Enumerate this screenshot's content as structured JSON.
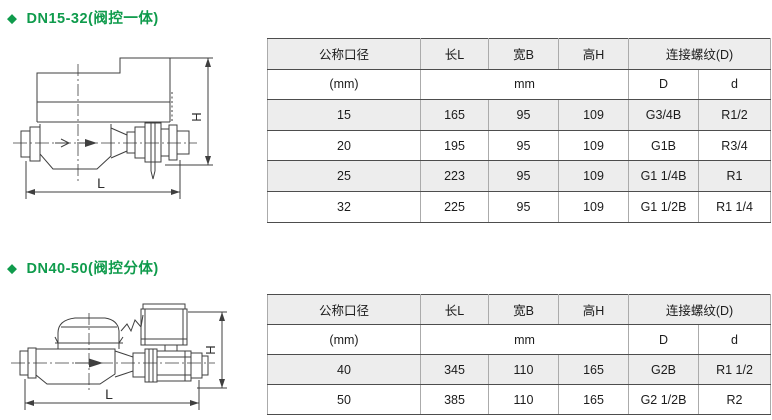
{
  "icons": {
    "diamond": "◆"
  },
  "colors": {
    "accent_green": "#0f9b4c",
    "row_shade": "#ededed",
    "rule_dark": "#4d4d4d",
    "rule_light": "#ababab"
  },
  "section1": {
    "title": "DN15-32(阀控一体)",
    "diagram": {
      "dim_height_label": "H",
      "dim_length_label": "L"
    },
    "table": {
      "col_headers": {
        "diameter": "公称口径",
        "length": "长L",
        "width": "宽B",
        "height": "高H",
        "thread": "连接螺纹(D)"
      },
      "unit_row": {
        "diameter_unit": "(mm)",
        "dims_unit": "mm",
        "thread_D": "D",
        "thread_d": "d"
      },
      "rows": [
        {
          "dn": "15",
          "l": "165",
          "b": "95",
          "h": "109",
          "thread_D": "G3/4B",
          "thread_d": "R1/2"
        },
        {
          "dn": "20",
          "l": "195",
          "b": "95",
          "h": "109",
          "thread_D": "G1B",
          "thread_d": "R3/4"
        },
        {
          "dn": "25",
          "l": "223",
          "b": "95",
          "h": "109",
          "thread_D": "G1 1/4B",
          "thread_d": "R1"
        },
        {
          "dn": "32",
          "l": "225",
          "b": "95",
          "h": "109",
          "thread_D": "G1 1/2B",
          "thread_d": "R1 1/4"
        }
      ]
    }
  },
  "section2": {
    "title": "DN40-50(阀控分体)",
    "diagram": {
      "dim_height_label": "H",
      "dim_length_label": "L"
    },
    "table": {
      "col_headers": {
        "diameter": "公称口径",
        "length": "长L",
        "width": "宽B",
        "height": "高H",
        "thread": "连接螺纹(D)"
      },
      "unit_row": {
        "diameter_unit": "(mm)",
        "dims_unit": "mm",
        "thread_D": "D",
        "thread_d": "d"
      },
      "rows": [
        {
          "dn": "40",
          "l": "345",
          "b": "110",
          "h": "165",
          "thread_D": "G2B",
          "thread_d": "R1 1/2"
        },
        {
          "dn": "50",
          "l": "385",
          "b": "110",
          "h": "165",
          "thread_D": "G2 1/2B",
          "thread_d": "R2"
        }
      ]
    }
  }
}
